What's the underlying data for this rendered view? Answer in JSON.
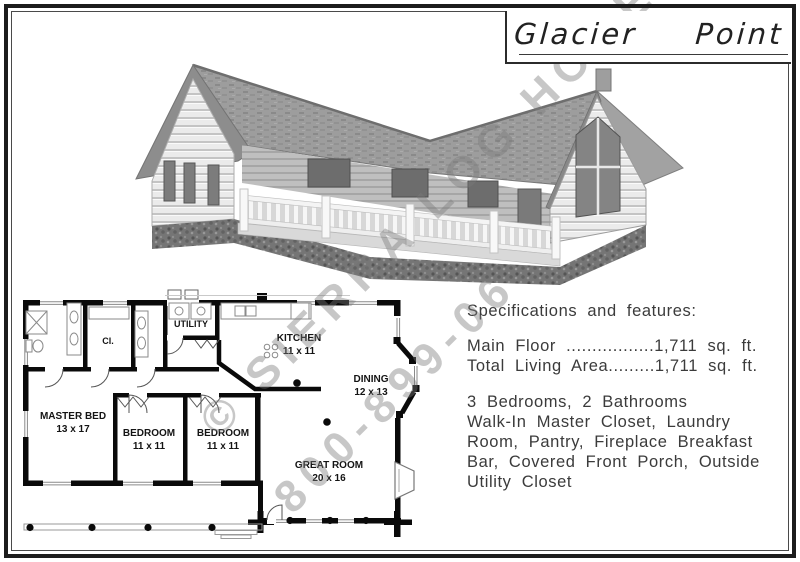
{
  "page": {
    "title": "Glacier Point"
  },
  "watermark": {
    "line1": "© SIERRA LOG HOMES",
    "line2": "800-899-06"
  },
  "specs": {
    "heading": "Specifications and features:",
    "main_floor_line": "Main Floor .................1,711 sq. ft.",
    "total_living_line": "Total Living Area.........1,711 sq. ft.",
    "features": [
      "3 Bedrooms, 2 Bathrooms",
      "Walk-In Master Closet, Laundry",
      "Room, Pantry, Fireplace Breakfast",
      "Bar, Covered Front Porch, Outside",
      "Utility Closet"
    ]
  },
  "floorplan": {
    "rooms": [
      {
        "name": "MASTER BED",
        "dims": "13 x 17"
      },
      {
        "name": "BEDROOM",
        "dims": "11 x 11"
      },
      {
        "name": "BEDROOM",
        "dims": "11 x 11"
      },
      {
        "name": "KITCHEN",
        "dims": "11 x 11"
      },
      {
        "name": "DINING",
        "dims": "12 x 13"
      },
      {
        "name": "GREAT ROOM",
        "dims": "20 x 16"
      },
      {
        "name": "UTILITY",
        "dims": ""
      },
      {
        "name": "Cl.",
        "dims": ""
      }
    ]
  },
  "colors": {
    "wall": "#0a0a0a",
    "watermark": "#7a7a7a",
    "text": "#3b3b3b",
    "border": "#1c1c1c"
  }
}
